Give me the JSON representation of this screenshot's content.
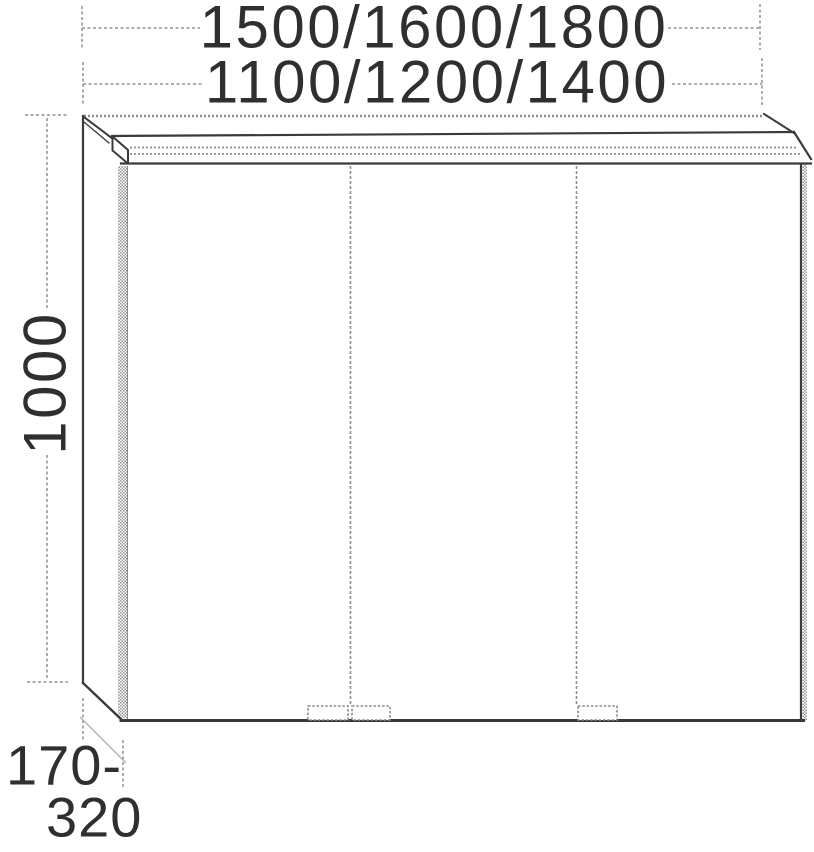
{
  "dimensions": {
    "width_options_top": "1500/1600/1800",
    "width_options_bottom": "1100/1200/1400",
    "height": "1000",
    "depth_range_line1": "170-",
    "depth_range_line2": "320"
  },
  "colors": {
    "line_dark": "#3a3a3a",
    "line_grey_dotted": "#8f8f8f",
    "dimension_text": "#2f2f2f",
    "background": "#ffffff"
  }
}
